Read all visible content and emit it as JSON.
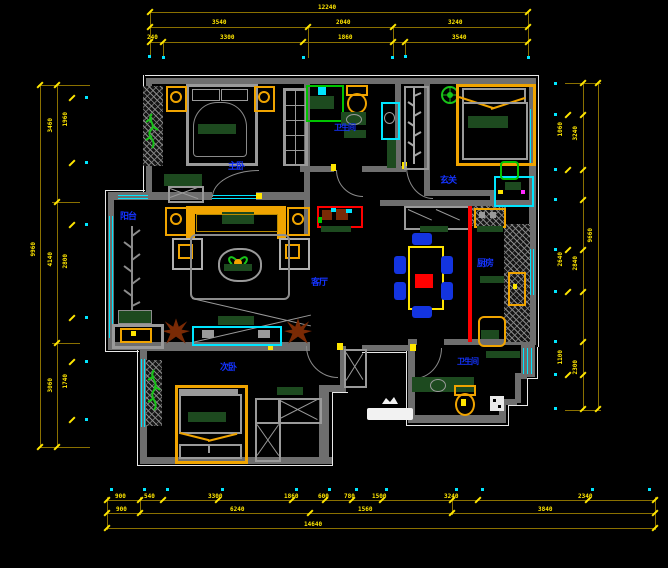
{
  "title": "住宅平面布置图",
  "colors": {
    "background": "#000000",
    "wall": "#6e6e6e",
    "dimension_line": "#8a7000",
    "dimension_text": "#ffe600",
    "window": "#00e5ff",
    "room_label": "#1433ff",
    "furniture_accent": "#f0a400",
    "soft_green": "#1d4a1f",
    "divider_red": "#ff0000",
    "outline_white": "#e8e8e8"
  },
  "rooms": {
    "master_bedroom": "主卧",
    "bathroom": "卫生间",
    "balcony": "阳台",
    "living_room": "客厅",
    "entry": "玄关",
    "kitchen": "厨房",
    "bedroom2": "次卧",
    "bathroom2": "卫生间"
  },
  "dims": {
    "top": {
      "outer": [
        "12240"
      ],
      "mid": [
        "3540",
        "2040",
        "3240"
      ],
      "inner": [
        "240",
        "3300",
        "1860",
        "3540"
      ]
    },
    "bottom": {
      "outer": [
        "14640"
      ],
      "mid": [
        "900",
        "6240",
        "1560",
        "3840"
      ],
      "inner": [
        "900",
        "540",
        "3300",
        "1860",
        "600",
        "780",
        "1500",
        "3240",
        "2340"
      ]
    },
    "left": {
      "outer": [
        "9960"
      ],
      "mid": [
        "3460",
        "4140",
        "3060"
      ],
      "inner": [
        "1960",
        "2800",
        "1740"
      ]
    },
    "right": {
      "outer": [
        "9660"
      ],
      "mid": [
        "3240",
        "2840",
        "2300"
      ],
      "inner": [
        "1060",
        "2640",
        "1100"
      ]
    }
  }
}
